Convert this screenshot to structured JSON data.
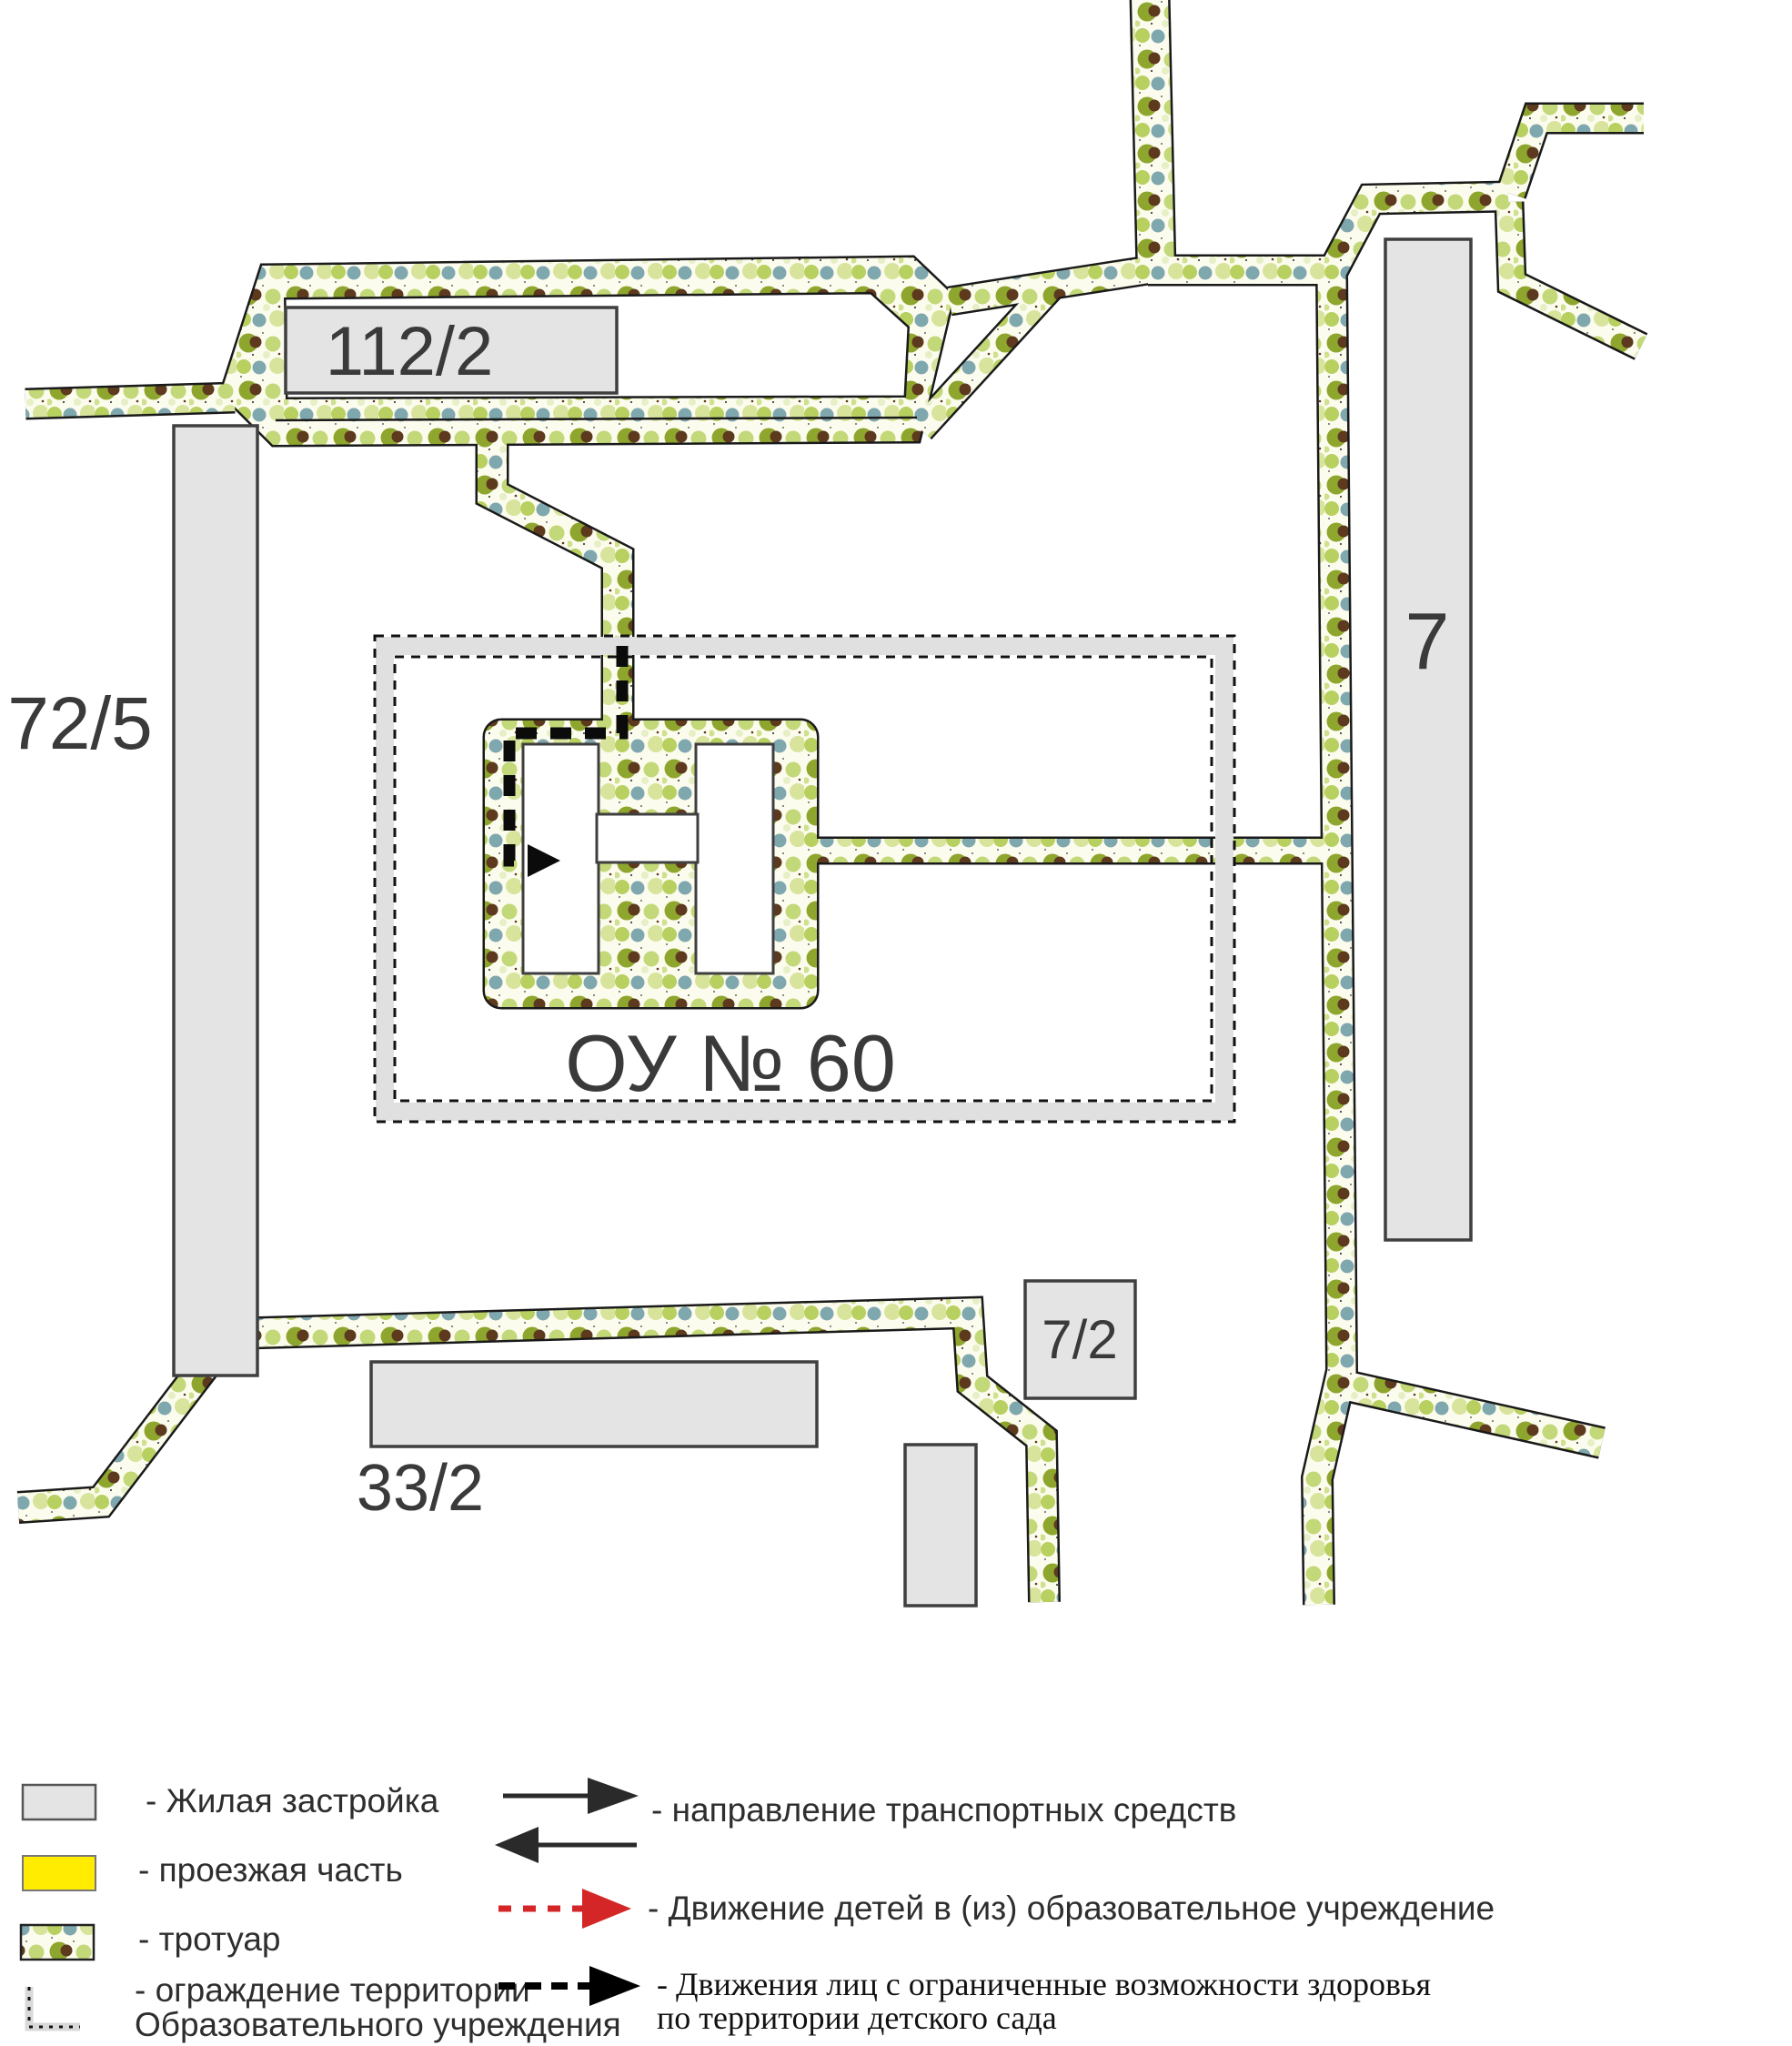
{
  "map": {
    "school_label": "ОУ № 60",
    "buildings": [
      {
        "id": "112-2",
        "label": "112/2"
      },
      {
        "id": "72-5",
        "label": "72/5"
      },
      {
        "id": "7",
        "label": "7"
      },
      {
        "id": "7-2",
        "label": "7/2"
      },
      {
        "id": "33-2",
        "label": "33/2"
      }
    ]
  },
  "legend": {
    "items_left": [
      {
        "symbol": "residential-swatch",
        "label": "- Жилая застройка"
      },
      {
        "symbol": "roadway-swatch",
        "label": "- проезжая часть"
      },
      {
        "symbol": "sidewalk-swatch",
        "label": "- тротуар"
      },
      {
        "symbol": "fence-symbol",
        "label": "- ограждение территории",
        "label2": "Образовательного учреждения"
      }
    ],
    "items_right": [
      {
        "symbol": "traffic-arrows",
        "label": "- направление транспортных средств"
      },
      {
        "symbol": "children-route-arrow",
        "label": "- Движение детей в (из) образовательное учреждение"
      },
      {
        "symbol": "disabled-route-arrow",
        "label": "- Движения лиц с ограниченные возможности здоровья",
        "label2": "по территории детского сада"
      }
    ]
  },
  "colors": {
    "road_yellow": "#ffec00",
    "accent_red": "#d42627",
    "building_fill": "#e4e4e4",
    "building_stroke": "#3f3f3f",
    "sidewalk_bg": "#fcfcee",
    "dot_olive": "#8fa62e",
    "dot_brown": "#5d3a1e",
    "dot_blue": "#7fa7ae",
    "dot_light_green": "#c3d878",
    "fence_gray": "#e0e0e0",
    "route_black": "#0b0b0b"
  }
}
